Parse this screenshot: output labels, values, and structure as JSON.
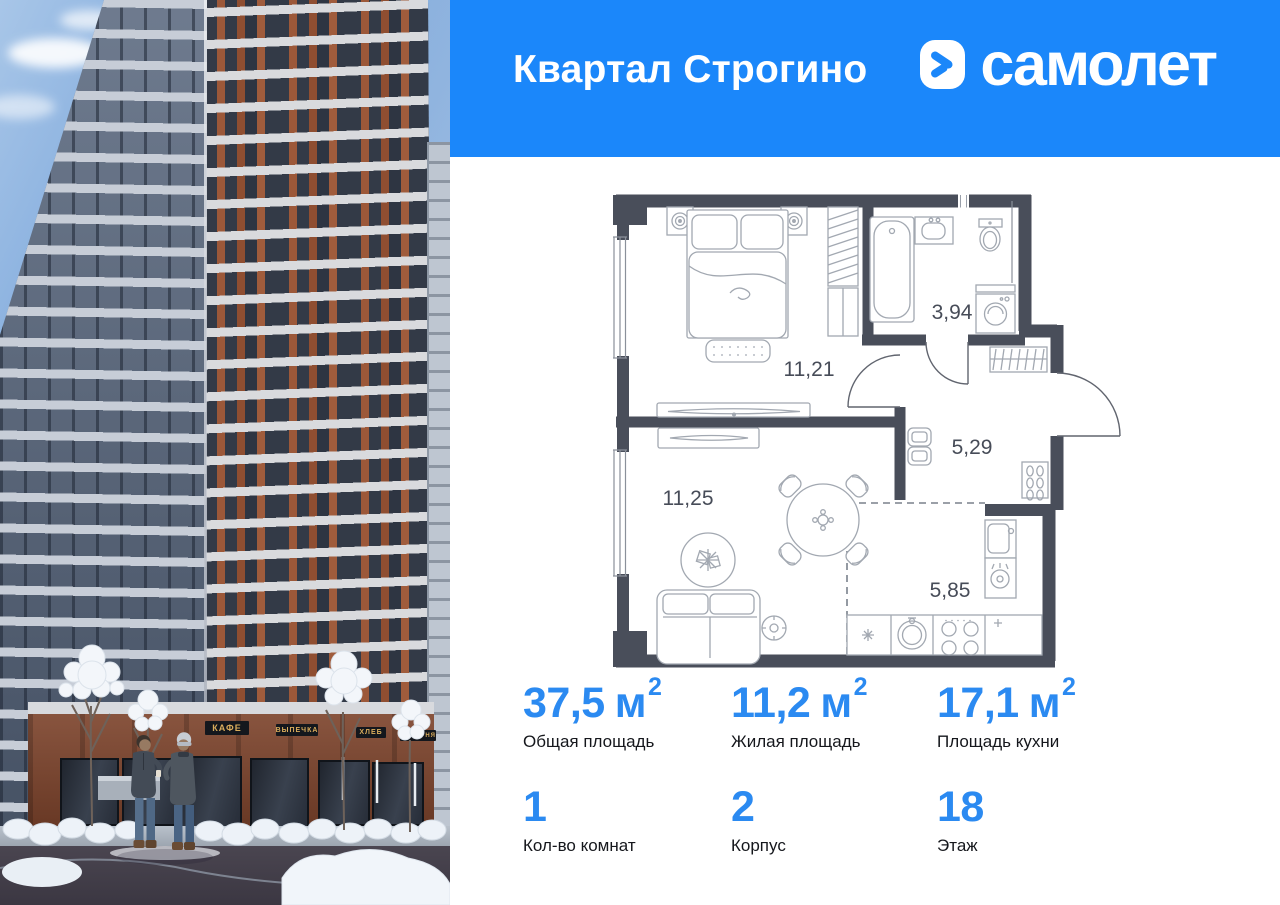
{
  "header": {
    "title": "Квартал Строгино",
    "brand": "самолет"
  },
  "photo": {
    "signs": [
      "КАФЕ",
      "ВЫПЕЧКА",
      "ХЛЕБ",
      "ПЕКАРНЯ"
    ]
  },
  "floor_plan": {
    "labels": {
      "bedroom": "11,21",
      "bathroom": "3,94",
      "hallway": "5,29",
      "living": "11,25",
      "kitchen": "5,85"
    }
  },
  "stats": {
    "cells": [
      {
        "value": "37,5",
        "unit": "м",
        "sup": "2",
        "label": "Общая площадь"
      },
      {
        "value": "11,2",
        "unit": "м",
        "sup": "2",
        "label": "Жилая площадь"
      },
      {
        "value": "17,1",
        "unit": "м",
        "sup": "2",
        "label": "Площадь кухни"
      },
      {
        "value": "1",
        "label": "Кол-во комнат"
      },
      {
        "value": "2",
        "label": "Корпус"
      },
      {
        "value": "18",
        "label": "Этаж"
      }
    ]
  },
  "colors": {
    "accent_blue": "#1B87FA",
    "stat_number_blue": "#2B8AF1",
    "plan_wall": "#494E5A"
  }
}
